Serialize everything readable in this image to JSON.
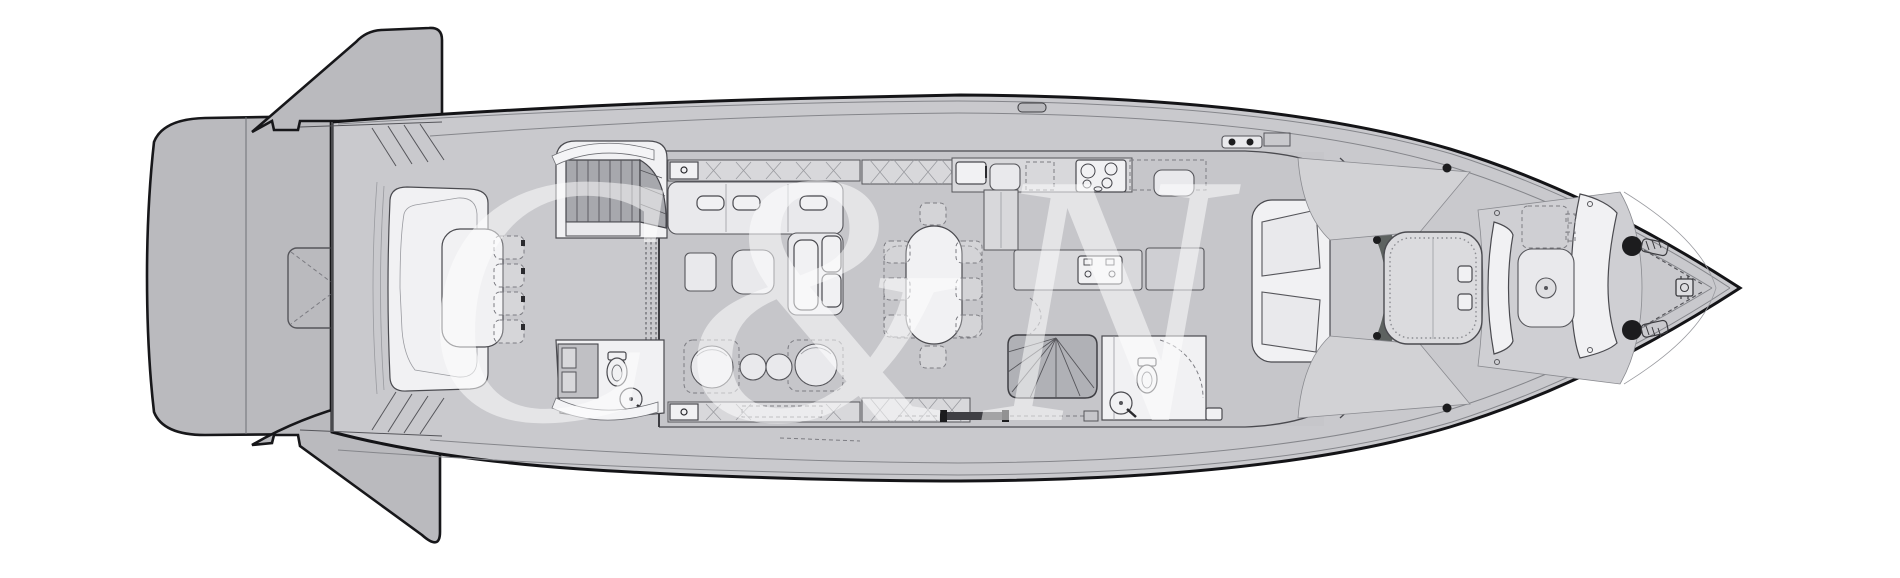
{
  "meta": {
    "description": "Yacht main-deck floor plan, top view, monochrome technical drawing"
  },
  "watermark": {
    "text": "C&N"
  },
  "colors": {
    "background": "#ffffff",
    "hull_fill": "#c9c9cd",
    "cabin_floor": "#c6c6ca",
    "platform_fill": "#bababe",
    "foredeck_pad": "#dbdbde",
    "furniture_light": "#e9e9ec",
    "furniture_white": "#f1f1f3",
    "stair_tread": "#a7a8ad",
    "windshield": "#5d6260",
    "outline_dark": "#17171a",
    "outline_medium": "#4a4a4f",
    "watermark": "rgba(255,255,255,0.52)"
  },
  "features": [
    "swim-platform",
    "transom-wing-top",
    "transom-wing-bottom",
    "garage-hatch",
    "aft-deck-sofa",
    "aft-deck-table",
    "aft-deck-chairs",
    "aft-staircase",
    "aft-day-head",
    "salon-sofa",
    "coffee-table",
    "armchair",
    "pouf",
    "tv-sideboard",
    "sliding-door",
    "dining-table",
    "dining-chair",
    "galley-counter",
    "cooktop",
    "galley-sink",
    "fridge",
    "galley-island",
    "bar-counter",
    "stairs-to-lower-deck",
    "forward-day-head",
    "helm-seat",
    "helm-console",
    "windshield",
    "foredeck-sunpad",
    "bow-bench",
    "bow-table",
    "bow-hatch",
    "anchor-windlass",
    "bow-roller",
    "deck-cleat",
    "boarding-gate"
  ]
}
